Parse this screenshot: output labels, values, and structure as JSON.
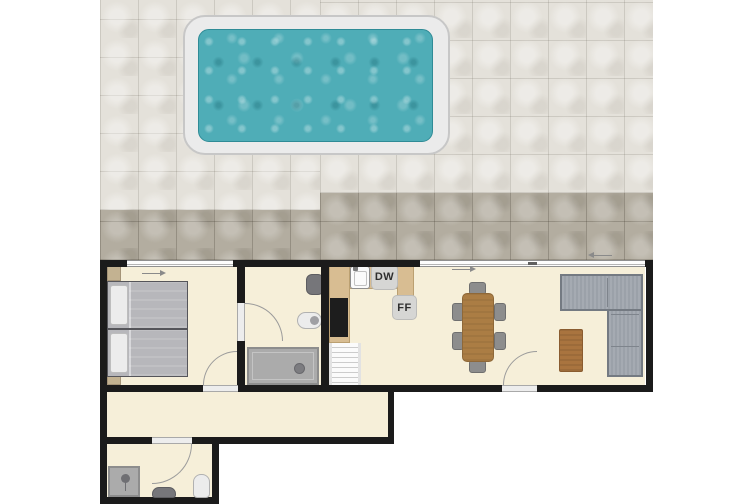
{
  "labels": {
    "dishwasher": "DW",
    "fridge_freezer": "FF"
  },
  "colors": {
    "wall": "#1b1b1b",
    "floor": "#f6efd9",
    "patio_light": "#e4e1da",
    "patio_dark": "#b3ada0",
    "pool_deck": "#ebebeb",
    "pool_water": "#4fadb7",
    "counter": "#d8bd92",
    "appliance_tile": "#d6d6d4",
    "table_wood": "#ab7d44",
    "coffee_wood": "#a9743f",
    "sofa": "#9ba1a9",
    "shower": "#ababab",
    "bed_blanket": "#b7b7bb",
    "fixture_dark": "#76767a",
    "arc": "#9b9b9b"
  },
  "plan": {
    "outdoor": [
      "tiled-patio",
      "swimming-pool"
    ],
    "rooms": [
      {
        "name": "bedroom",
        "features": [
          "twin-bed",
          "twin-bed",
          "nightstand",
          "nightstand",
          "window"
        ]
      },
      {
        "name": "bathroom",
        "features": [
          "toilet",
          "washbasin",
          "shower"
        ]
      },
      {
        "name": "kitchen-dining-living",
        "features": [
          "kitchen-counter",
          "sink",
          "dishwasher",
          "fridge-freezer",
          "cooktop",
          "staircase",
          "dining-table",
          "six-chairs",
          "corner-sofa",
          "coffee-table",
          "sliding-patio-door"
        ]
      },
      {
        "name": "hallway",
        "features": []
      },
      {
        "name": "wc",
        "features": [
          "shower",
          "washbasin",
          "toilet"
        ]
      }
    ]
  }
}
